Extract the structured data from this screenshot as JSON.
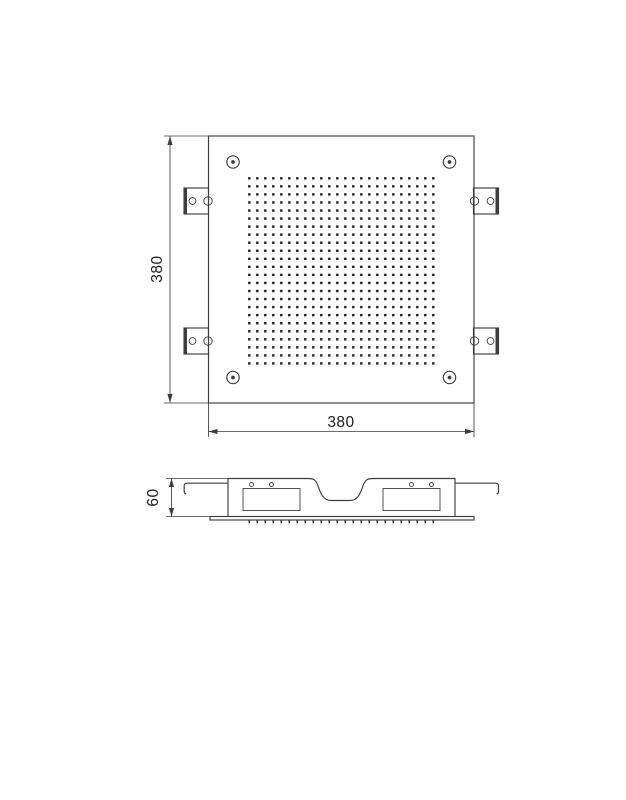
{
  "drawing": {
    "kind": "technical-dimension-drawing",
    "subject": "square recessed ceiling shower head",
    "views": {
      "top": {
        "width_dim": "380",
        "height_dim": "380",
        "perforation_grid": {
          "cols": 24,
          "rows": 24
        },
        "corner_screw_count": 4,
        "mounting_bracket_count": 4
      },
      "side": {
        "height_dim": "60",
        "nozzle_tick_count": 24
      }
    },
    "colors": {
      "background": "#ffffff",
      "line": "#3d3d3d",
      "text": "#1c1c1c",
      "dot": "#1f1f1f"
    }
  }
}
